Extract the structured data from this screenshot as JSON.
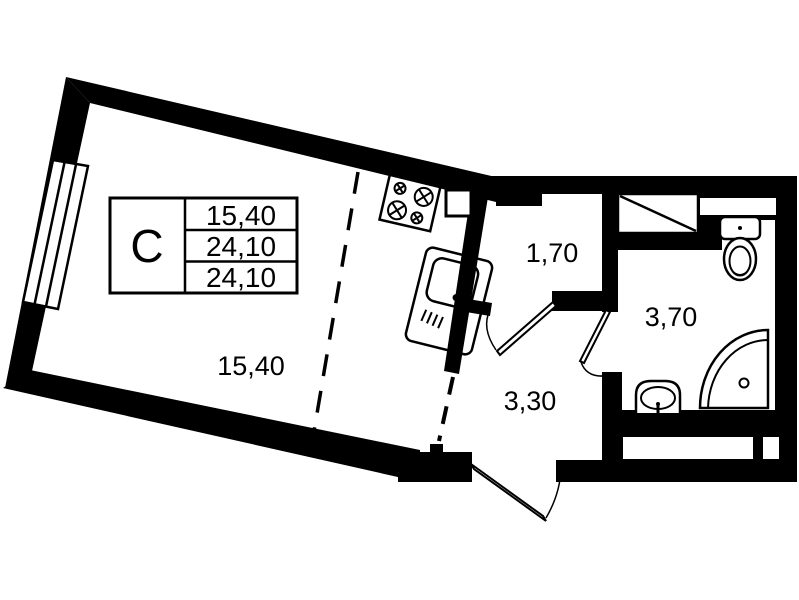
{
  "plan": {
    "title": "studio apartment floor plan",
    "colors": {
      "wall": "#000000",
      "floor": "#ffffff"
    },
    "legend": {
      "type_label": "С",
      "rows": [
        "15,40",
        "24,10",
        "24,10"
      ]
    },
    "rooms": [
      {
        "id": "main-room",
        "area_label": "15,40"
      },
      {
        "id": "upper-hall",
        "area_label": "1,70"
      },
      {
        "id": "bathroom",
        "area_label": "3,70"
      },
      {
        "id": "hallway",
        "area_label": "3,30"
      }
    ],
    "icons": [
      "window-icon",
      "stove-icon",
      "kitchen-sink-icon",
      "toilet-icon",
      "shower-icon",
      "washbasin-icon",
      "vent-shaft-icon",
      "door-icon"
    ]
  }
}
